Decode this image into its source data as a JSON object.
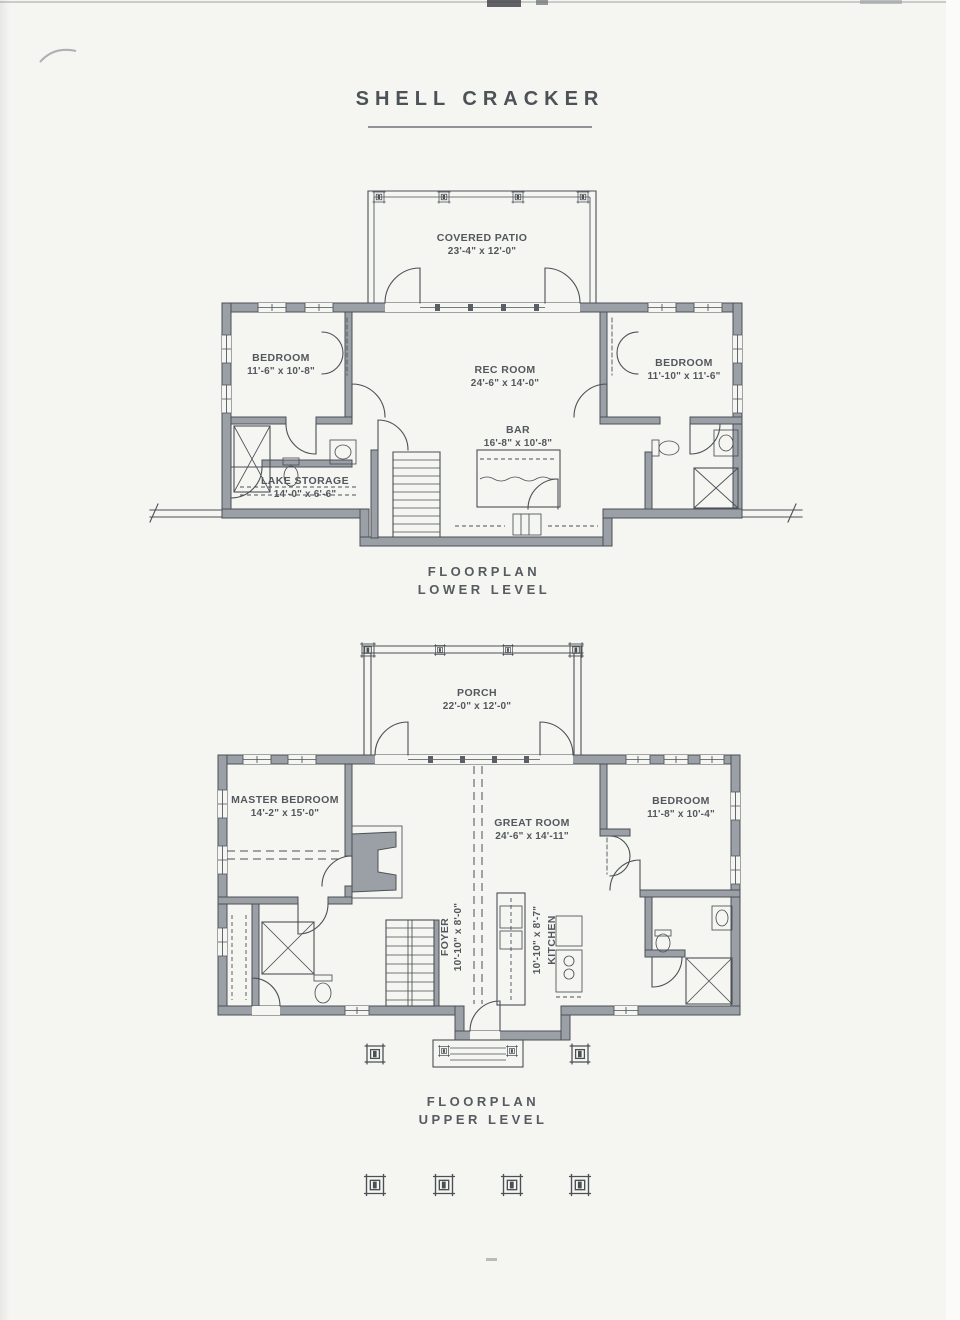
{
  "title": "SHELL CRACKER",
  "plans": {
    "lower": {
      "caption": {
        "line1": "FLOORPLAN",
        "line2": "LOWER LEVEL"
      },
      "rooms": [
        {
          "name": "COVERED PATIO",
          "dims": "23'-4\" x 12'-0\""
        },
        {
          "name": "BEDROOM",
          "dims": "11'-6\" x 10'-8\""
        },
        {
          "name": "REC ROOM",
          "dims": "24'-6\" x 14'-0\""
        },
        {
          "name": "BEDROOM",
          "dims": "11'-10\" x 11'-6\""
        },
        {
          "name": "BAR",
          "dims": "16'-8\" x 10'-8\""
        },
        {
          "name": "LAKE STORAGE",
          "dims": "14'-0\" x 6'-6\""
        }
      ]
    },
    "upper": {
      "caption": {
        "line1": "FLOORPLAN",
        "line2": "UPPER LEVEL"
      },
      "rooms": [
        {
          "name": "PORCH",
          "dims": "22'-0\" x 12'-0\""
        },
        {
          "name": "MASTER BEDROOM",
          "dims": "14'-2\" x 15'-0\""
        },
        {
          "name": "GREAT ROOM",
          "dims": "24'-6\" x 14'-11\""
        },
        {
          "name": "BEDROOM",
          "dims": "11'-8\" x 10'-4\""
        },
        {
          "name": "FOYER",
          "dims": "10'-10\" x 8'-0\""
        },
        {
          "name": "KITCHEN",
          "dims": "10'-10\" x 8'-7\""
        }
      ]
    }
  },
  "colors": {
    "paper": "#f5f5f2",
    "wall_fill": "#9aa0a5",
    "line": "#4b5055",
    "text": "#53585d"
  }
}
